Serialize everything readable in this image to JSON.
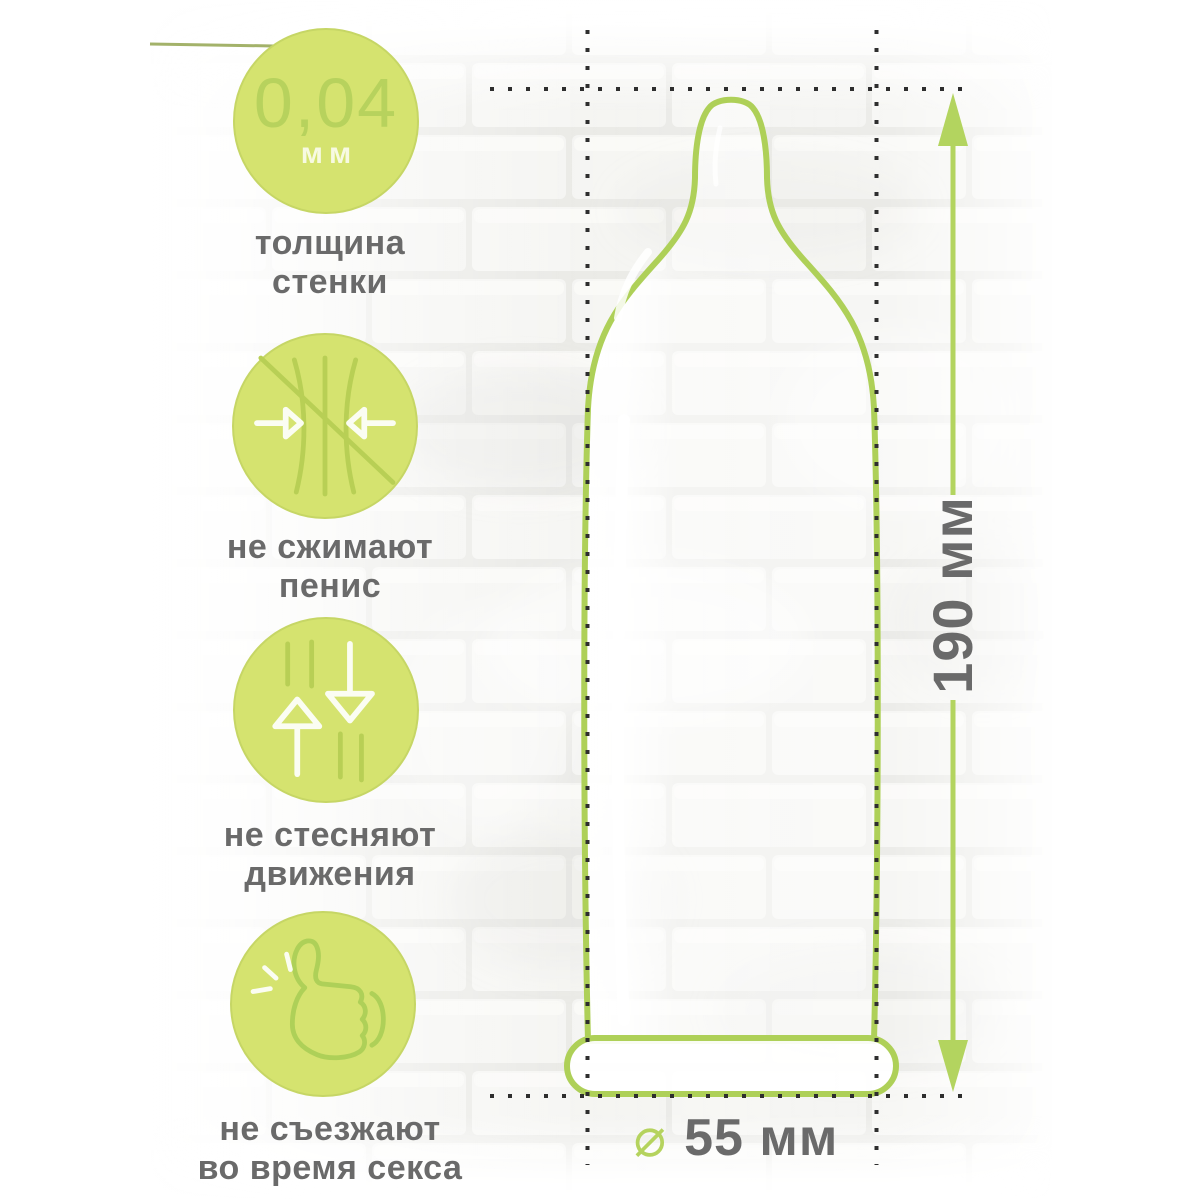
{
  "features": [
    {
      "badge": "wall-thickness-badge",
      "value": "0,04",
      "unit": "мм",
      "lines": [
        "толщина",
        "стенки"
      ]
    },
    {
      "badge": "no-squeeze-badge",
      "icon": "no-squeeze-icon",
      "lines": [
        "не сжимают",
        "пенис"
      ]
    },
    {
      "badge": "free-movement-badge",
      "icon": "free-movement-icon",
      "lines": [
        "не стесняют",
        "движения"
      ]
    },
    {
      "badge": "no-slip-badge",
      "icon": "thumbs-up-icon",
      "lines": [
        "не съезжают",
        "во время секса"
      ]
    }
  ],
  "measurements": {
    "length": "190 мм",
    "diameter": "55 мм",
    "diameter_symbol": "⌀"
  },
  "colors": {
    "accent_green": "#aed058",
    "badge_fill": "#d5e36f",
    "icon_stroke": "#b8cf55",
    "text_gray": "#6a6a6a",
    "dots_black": "#2e2e2e"
  }
}
